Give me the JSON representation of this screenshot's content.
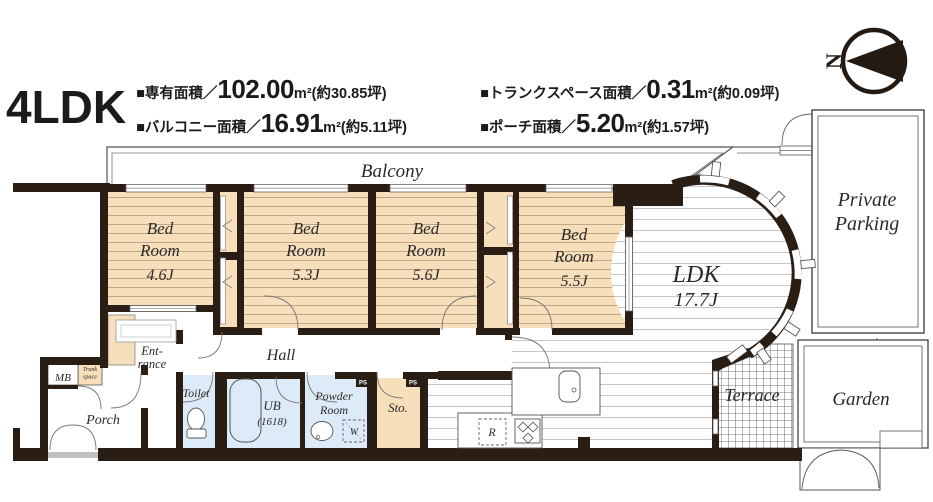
{
  "colors": {
    "wall": "#2a1d14",
    "tatami_peach": "#f7dfbc",
    "wet_room_blue": "#dcebf7",
    "floor_line_gray": "#c6c6c6",
    "line_dark": "#555555"
  },
  "header": {
    "title": "4LDK",
    "specs": [
      {
        "label": "■専有面積／",
        "value": "102.00",
        "rest": "m²(約30.85坪)"
      },
      {
        "label": "■トランクスペース面積／",
        "value": "0.31",
        "rest": "m²(約0.09坪)"
      },
      {
        "label": "■バルコニー面積／",
        "value": "16.91",
        "rest": "m²(約5.11坪)"
      },
      {
        "label": "■ポーチ面積／",
        "value": "5.20",
        "rest": "m²(約1.57坪)"
      }
    ],
    "compass_label": "N"
  },
  "plan": {
    "balcony": "Balcony",
    "bedroom1": {
      "l1": "Bed",
      "l2": "Room",
      "size": "4.6J"
    },
    "bedroom2": {
      "l1": "Bed",
      "l2": "Room",
      "size": "5.3J"
    },
    "bedroom3": {
      "l1": "Bed",
      "l2": "Room",
      "size": "5.6J"
    },
    "bedroom4": {
      "l1": "Bed",
      "l2": "Room",
      "size": "5.5J"
    },
    "ldk": {
      "name": "LDK",
      "size": "17.7J"
    },
    "parking": {
      "l1": "Private",
      "l2": "Parking"
    },
    "garden": "Garden",
    "terrace": "Terrace",
    "entrance": {
      "l1": "Ent-",
      "l2": "rance"
    },
    "hall": "Hall",
    "porch": "Porch",
    "mb": "MB",
    "trunk": {
      "l1": "Trunk",
      "l2": "space"
    },
    "toilet": "Toilet",
    "ub": {
      "l1": "UB",
      "l2": "(1618)"
    },
    "powder": {
      "l1": "Powder",
      "l2": "Room"
    },
    "storage": "Sto.",
    "washer": "W",
    "fridge": "R",
    "ps": "PS"
  }
}
